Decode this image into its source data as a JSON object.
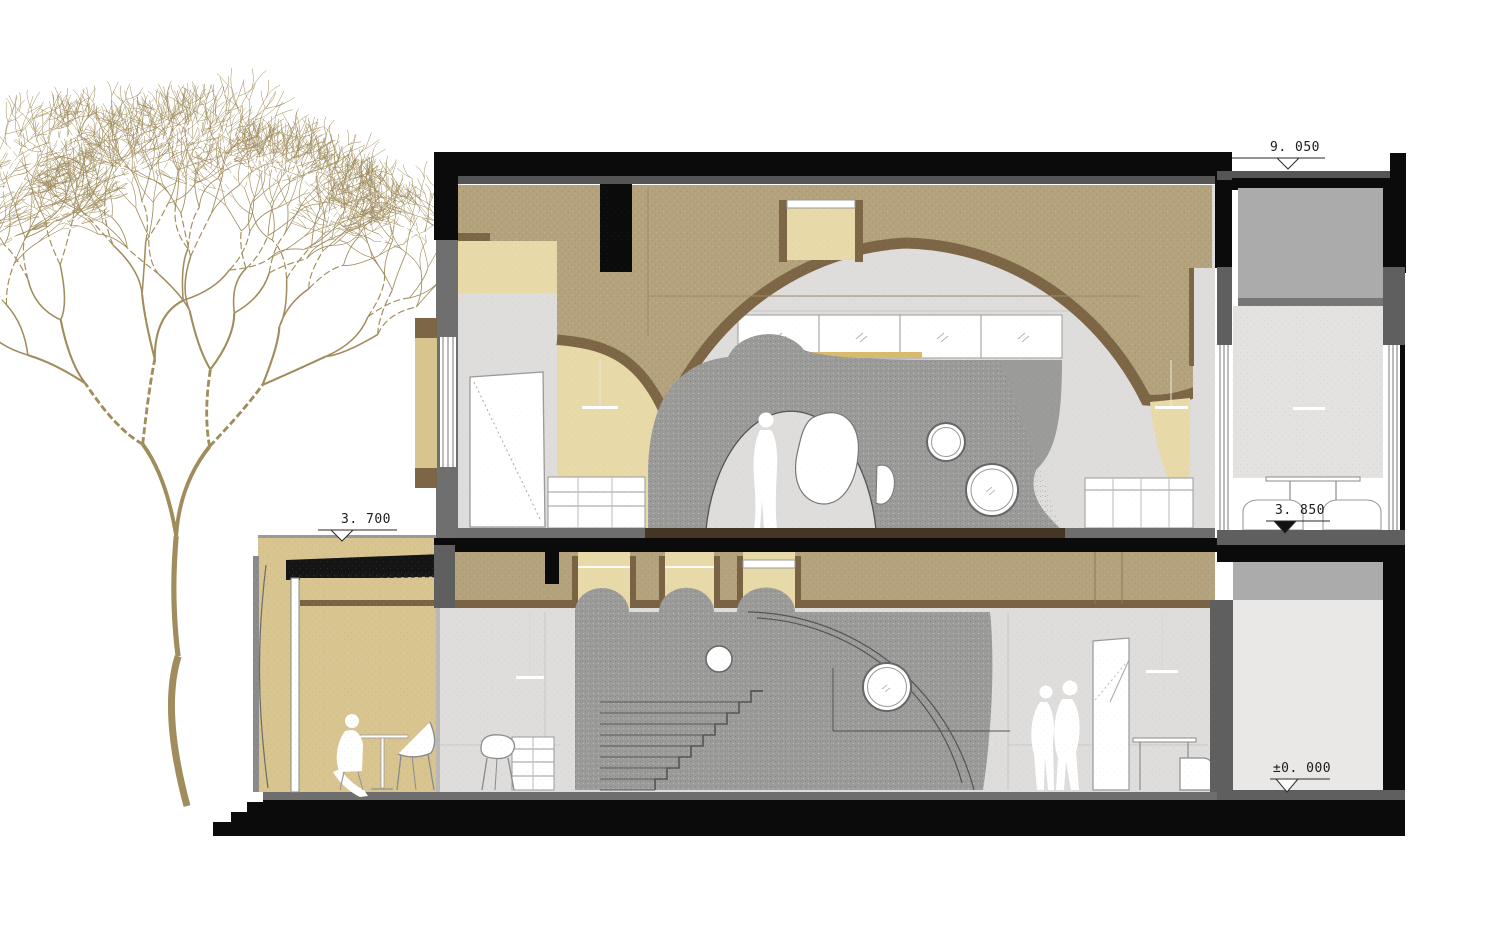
{
  "title": "Building cross-section drawing",
  "annotations": [
    {
      "id": "roof-level",
      "label": "9. 050"
    },
    {
      "id": "canopy-level",
      "label": "3. 700"
    },
    {
      "id": "upper-floor-level",
      "label": "3. 850"
    },
    {
      "id": "ground-level",
      "label": "±0. 000"
    }
  ],
  "palette": {
    "vault_dark_tan": "#b3a27c",
    "vault_light_tan": "#e8d9a8",
    "rim_brown": "#7c6645",
    "floor_dark_brown": "#453524",
    "cave_gray": "#9b9b99",
    "wall_light_gray": "#dedddb",
    "shaft_smooth_gray": "#e9e8e6",
    "elevator_box_gray": "#ababab",
    "structure_dark_gray": "#5f5f5f",
    "poche_black": "#0b0b0b",
    "tree_line": "#a08c5c",
    "annotation_ink": "#1c1c1c"
  },
  "scene": {
    "tree": "bare-deciduous-tree-line-drawing",
    "figures": [
      "standing-person-upper-floor",
      "seated-person-porch",
      "two-standing-people-ground-floor"
    ],
    "openings": [
      "large-arch-upper-floor",
      "porthole-windows",
      "organic-blob-opening",
      "three-ceiling-niches",
      "skylight-niche"
    ]
  }
}
